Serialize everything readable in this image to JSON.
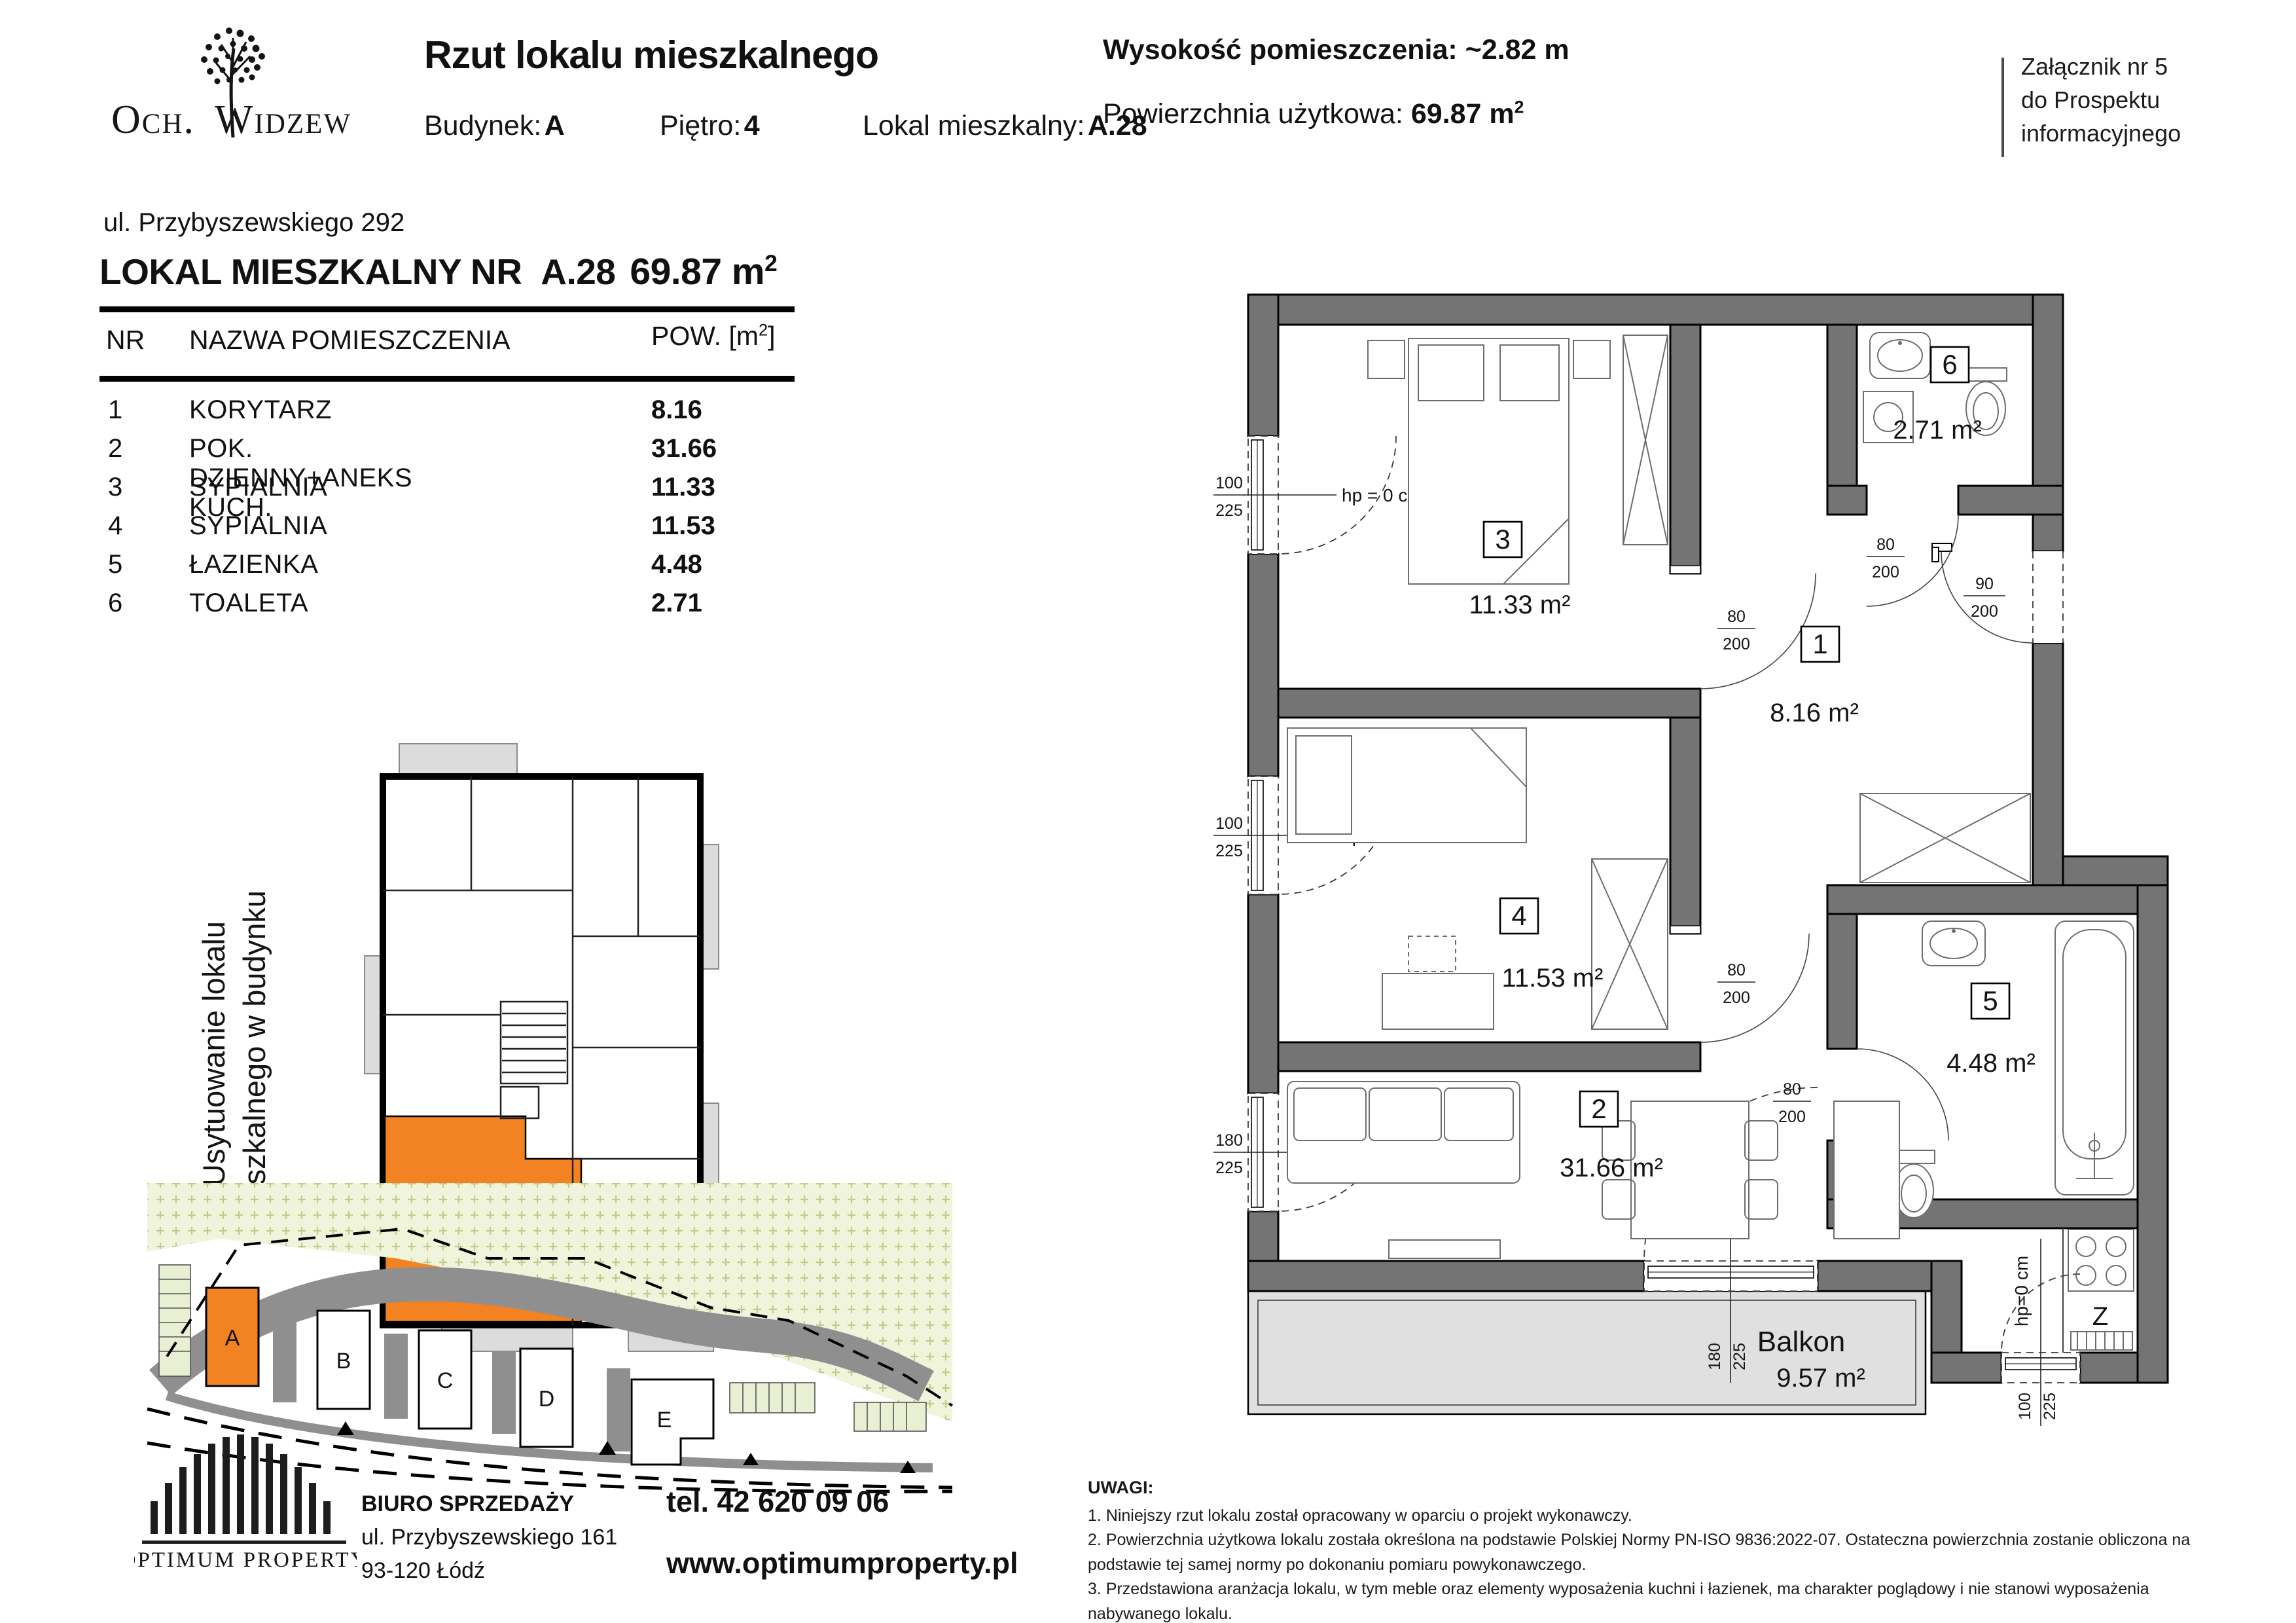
{
  "colors": {
    "accent_orange": "#F28222",
    "wall_gray": "#747474",
    "balcony_gray": "#E0E0E0",
    "site_green": "#EFF4DB",
    "road_gray": "#8F8F8F"
  },
  "header": {
    "logo": {
      "left": "Och.",
      "right": "Widzew"
    },
    "title": "Rzut lokalu mieszkalnego",
    "building_label": "Budynek:",
    "building_value": "A",
    "floor_label": "Piętro:",
    "floor_value": "4",
    "unit_label": "Lokal mieszkalny:",
    "unit_value": "A.28",
    "height_label": "Wysokość pomieszczenia:",
    "height_value": "~2.82 m",
    "area_label": "Powierzchnia użytkowa:",
    "area_value": "69.87 m",
    "area_sup": "2",
    "attachment_lines": [
      "Załącznik nr 5",
      "do Prospektu",
      "informacyjnego"
    ]
  },
  "unit": {
    "address": "ul. Przybyszewskiego  292",
    "title_prefix": "LOKAL MIESZKALNY NR",
    "title_number": "A.28",
    "title_area": "69.87 m",
    "title_area_sup": "2"
  },
  "table": {
    "col_nr": "NR",
    "col_name": "NAZWA POMIESZCZENIA",
    "col_pow_prefix": "POW. [m",
    "col_pow_sup": "2",
    "col_pow_suffix": "]",
    "rows": [
      {
        "nr": "1",
        "name": "KORYTARZ",
        "area": "8.16"
      },
      {
        "nr": "2",
        "name": "POK. DZIENNY+ANEKS KUCH.",
        "area": "31.66"
      },
      {
        "nr": "3",
        "name": "SYPIALNIA",
        "area": "11.33"
      },
      {
        "nr": "4",
        "name": "SYPIALNIA",
        "area": "11.53"
      },
      {
        "nr": "5",
        "name": "ŁAZIENKA",
        "area": "4.48"
      },
      {
        "nr": "6",
        "name": "TOALETA",
        "area": "2.71"
      }
    ]
  },
  "location_caption": {
    "line1": "Usytuowanie lokalu",
    "line2": "miszkalnego w budynku"
  },
  "site": {
    "labels": [
      "A",
      "B",
      "C",
      "D",
      "E"
    ]
  },
  "floorplan": {
    "rooms": {
      "r1": {
        "num": "1",
        "area": "8.16  m²"
      },
      "r2": {
        "num": "2",
        "area": "31.66 m²"
      },
      "r3": {
        "num": "3",
        "area": "11.33  m²"
      },
      "r4": {
        "num": "4",
        "area": "11.53  m²"
      },
      "r5": {
        "num": "5",
        "area": "4.48  m²"
      },
      "r6": {
        "num": "6",
        "area": "2.71  m²"
      }
    },
    "balcony": {
      "label": "Balkon",
      "area": "9.57  m²"
    },
    "hp": "hp = 0 cm",
    "hp2": "hp=0 cm",
    "sink": "Z",
    "dims": {
      "win3": {
        "a": "100",
        "b": "225"
      },
      "win4": {
        "a": "100",
        "b": "225"
      },
      "win2": {
        "a": "180",
        "b": "225"
      },
      "balc_door": {
        "a": "180",
        "b": "225"
      },
      "balc_win": {
        "a": "100",
        "b": "225"
      },
      "entry": {
        "a": "90",
        "b": "200"
      },
      "door": {
        "a": "80",
        "b": "200"
      }
    }
  },
  "footer": {
    "brand": "OPTIMUM PROPERTY",
    "office_title": "BIURO SPRZEDAŻY",
    "office_addr1": "ul. Przybyszewskiego 161",
    "office_addr2": "93-120 Łódź",
    "phone": "tel. 42 620 09 06",
    "website": "www.optimumproperty.pl"
  },
  "notes": {
    "title": "UWAGI:",
    "items": [
      "1. Niniejszy rzut lokalu został opracowany w oparciu o projekt wykonawczy.",
      "2. Powierzchnia użytkowa lokalu została określona na podstawie Polskiej Normy PN-ISO 9836:2022-07.  Ostateczna powierzchnia zostanie obliczona na podstawie tej samej normy po dokonaniu pomiaru powykonawczego.",
      "3. Przedstawiona aranżacja lokalu, w tym meble oraz elementy wyposażenia kuchni i łazienek, ma charakter poglądowy i nie stanowi wyposażenia nabywanego lokalu."
    ]
  }
}
